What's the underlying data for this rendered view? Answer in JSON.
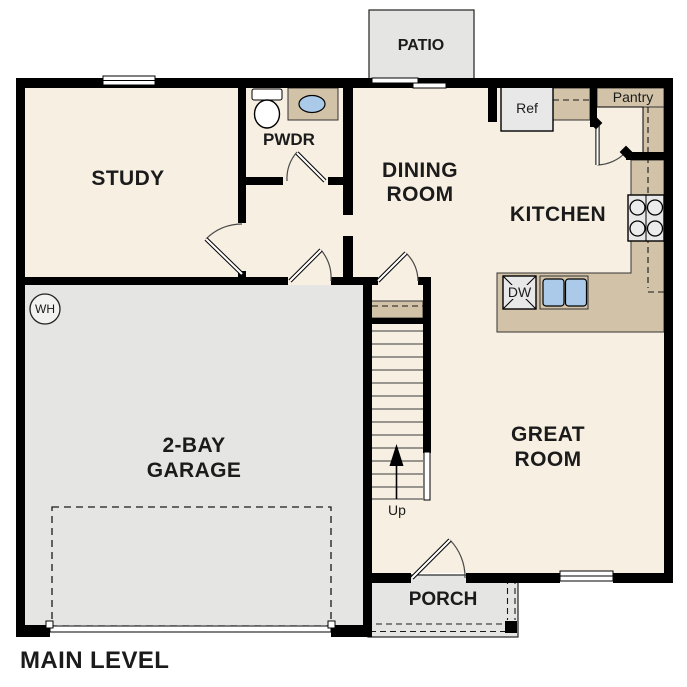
{
  "plan_title": "MAIN LEVEL",
  "palette": {
    "floor_beige": "#f7efe2",
    "concrete_gray": "#e5e5e3",
    "counter_tan": "#d2c3a8",
    "fixture_blue": "#abcaea",
    "appliance_gray": "#e8e8e8",
    "wall_black": "#000000",
    "label_text": "#1b1b1b"
  },
  "rooms": {
    "study": {
      "label": "STUDY"
    },
    "powder_room": {
      "label": "PWDR"
    },
    "dining_room": {
      "line1": "DINING",
      "line2": "ROOM"
    },
    "kitchen": {
      "label": "KITCHEN"
    },
    "great_room": {
      "line1": "GREAT",
      "line2": "ROOM"
    },
    "garage": {
      "line1": "2-BAY",
      "line2": "GARAGE"
    },
    "patio": {
      "label": "PATIO"
    },
    "porch": {
      "label": "PORCH"
    },
    "pantry": {
      "label": "Pantry"
    }
  },
  "fixtures": {
    "refrigerator": {
      "label": "Ref"
    },
    "dishwasher": {
      "label": "DW"
    },
    "water_heater": {
      "label": "WH"
    },
    "stairs": {
      "direction_label": "Up"
    }
  }
}
